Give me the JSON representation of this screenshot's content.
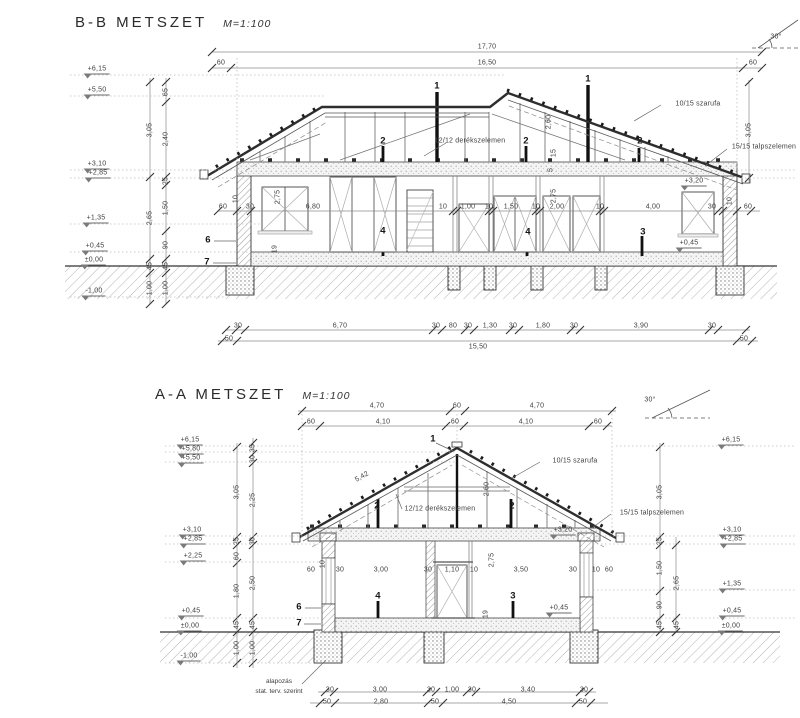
{
  "colors": {
    "paper": "#ffffff",
    "ink": "#3d3d3d",
    "bold": "#161616",
    "hatch": "#a8a8a8"
  },
  "bb": {
    "title": "B-B METSZET",
    "scale": "M=1:100",
    "labels": [
      {
        "t": "17,70",
        "x": 487,
        "y": 47
      },
      {
        "t": "16,50",
        "x": 487,
        "y": 63
      },
      {
        "t": "60",
        "x": 221,
        "y": 63
      },
      {
        "t": "60",
        "x": 753,
        "y": 63
      },
      {
        "t": "30°",
        "x": 776,
        "y": 37,
        "n": "roof-pitch-label"
      },
      {
        "t": "+6,15",
        "x": 97,
        "y": 70,
        "lv": 1
      },
      {
        "t": "+5,50",
        "x": 97,
        "y": 91,
        "lv": 1
      },
      {
        "t": "+3,10",
        "x": 97,
        "y": 165,
        "lv": 1
      },
      {
        "t": "+2,85",
        "x": 98,
        "y": 174,
        "lv": 1
      },
      {
        "t": "+1,35",
        "x": 96,
        "y": 219,
        "lv": 1
      },
      {
        "t": "+0,45",
        "x": 95,
        "y": 247,
        "lv": 1
      },
      {
        "t": "±0,00",
        "x": 94,
        "y": 261,
        "lv": 1
      },
      {
        "t": "-1,00",
        "x": 94,
        "y": 292,
        "lv": 1
      },
      {
        "t": "3,05",
        "x": 150,
        "y": 130,
        "r": -90
      },
      {
        "t": "2,65",
        "x": 150,
        "y": 218,
        "r": -90
      },
      {
        "t": "45",
        "x": 150,
        "y": 266,
        "r": -90
      },
      {
        "t": "1,00",
        "x": 150,
        "y": 288,
        "r": -90
      },
      {
        "t": "65",
        "x": 166,
        "y": 92,
        "r": -90
      },
      {
        "t": "2,40",
        "x": 166,
        "y": 139,
        "r": -90
      },
      {
        "t": "25",
        "x": 166,
        "y": 181,
        "r": -90
      },
      {
        "t": "1,50",
        "x": 166,
        "y": 208,
        "r": -90
      },
      {
        "t": "90",
        "x": 166,
        "y": 245,
        "r": -90
      },
      {
        "t": "45",
        "x": 166,
        "y": 266,
        "r": -90
      },
      {
        "t": "1,00",
        "x": 166,
        "y": 288,
        "r": -90
      },
      {
        "t": "3,05",
        "x": 749,
        "y": 130,
        "r": -90
      },
      {
        "t": "10/15 szarufa",
        "x": 698,
        "y": 104,
        "n": "rafter-label"
      },
      {
        "t": "15/15 talpszelemen",
        "x": 764,
        "y": 147,
        "n": "wall-plate-label"
      },
      {
        "t": "12/12 derékszelemen",
        "x": 470,
        "y": 141,
        "n": "purlin-label"
      },
      {
        "t": "2,60",
        "x": 549,
        "y": 122,
        "r": -90
      },
      {
        "t": "15",
        "x": 554,
        "y": 153,
        "r": -90
      },
      {
        "t": "5",
        "x": 551,
        "y": 170,
        "r": -90
      },
      {
        "t": "2,75",
        "x": 554,
        "y": 196,
        "r": -90
      },
      {
        "t": "2,75",
        "x": 278,
        "y": 197,
        "r": -90
      },
      {
        "t": "19",
        "x": 275,
        "y": 249,
        "r": -90
      },
      {
        "t": "10",
        "x": 236,
        "y": 199,
        "r": -90
      },
      {
        "t": "1",
        "x": 437,
        "y": 86,
        "b": 1
      },
      {
        "t": "1",
        "x": 588,
        "y": 79,
        "b": 1
      },
      {
        "t": "2",
        "x": 383,
        "y": 141,
        "b": 1
      },
      {
        "t": "2",
        "x": 526,
        "y": 141,
        "b": 1
      },
      {
        "t": "2",
        "x": 640,
        "y": 141,
        "b": 1
      },
      {
        "t": "4",
        "x": 383,
        "y": 231,
        "b": 1
      },
      {
        "t": "4",
        "x": 528,
        "y": 232,
        "b": 1
      },
      {
        "t": "3",
        "x": 643,
        "y": 232,
        "b": 1
      },
      {
        "t": "6",
        "x": 208,
        "y": 240,
        "b": 1
      },
      {
        "t": "7",
        "x": 207,
        "y": 262,
        "b": 1
      },
      {
        "t": "60",
        "x": 223,
        "y": 207
      },
      {
        "t": "30",
        "x": 250,
        "y": 207
      },
      {
        "t": "6,80",
        "x": 313,
        "y": 207
      },
      {
        "t": "10",
        "x": 443,
        "y": 207
      },
      {
        "t": "1,00",
        "x": 468,
        "y": 207
      },
      {
        "t": "10",
        "x": 489,
        "y": 207
      },
      {
        "t": "1,50",
        "x": 511,
        "y": 207
      },
      {
        "t": "10",
        "x": 536,
        "y": 207
      },
      {
        "t": "2,00",
        "x": 557,
        "y": 207
      },
      {
        "t": "10",
        "x": 600,
        "y": 207
      },
      {
        "t": "4,00",
        "x": 653,
        "y": 207
      },
      {
        "t": "30",
        "x": 712,
        "y": 207
      },
      {
        "t": "10",
        "x": 730,
        "y": 201,
        "r": -90
      },
      {
        "t": "60",
        "x": 748,
        "y": 207
      },
      {
        "t": "+3,20",
        "x": 694,
        "y": 182,
        "lv": 1
      },
      {
        "t": "+0,45",
        "x": 689,
        "y": 244,
        "lv": 1
      },
      {
        "t": "30",
        "x": 238,
        "y": 326
      },
      {
        "t": "6,70",
        "x": 340,
        "y": 326
      },
      {
        "t": "30",
        "x": 436,
        "y": 326
      },
      {
        "t": "80",
        "x": 453,
        "y": 326
      },
      {
        "t": "30",
        "x": 468,
        "y": 326
      },
      {
        "t": "1,30",
        "x": 490,
        "y": 326
      },
      {
        "t": "30",
        "x": 513,
        "y": 326
      },
      {
        "t": "1,80",
        "x": 543,
        "y": 326
      },
      {
        "t": "30",
        "x": 574,
        "y": 326
      },
      {
        "t": "3,90",
        "x": 641,
        "y": 326
      },
      {
        "t": "30",
        "x": 712,
        "y": 326
      },
      {
        "t": "50",
        "x": 229,
        "y": 339
      },
      {
        "t": "15,50",
        "x": 478,
        "y": 347
      },
      {
        "t": "50",
        "x": 744,
        "y": 339
      }
    ]
  },
  "aa": {
    "title": "A-A METSZET",
    "scale": "M=1:100",
    "note1": "alapozás",
    "note2": "stat. terv. szerint",
    "labels": [
      {
        "t": "4,70",
        "x": 377,
        "y": 406
      },
      {
        "t": "60",
        "x": 457,
        "y": 406
      },
      {
        "t": "4,70",
        "x": 537,
        "y": 406
      },
      {
        "t": "60",
        "x": 311,
        "y": 422
      },
      {
        "t": "4,10",
        "x": 383,
        "y": 422
      },
      {
        "t": "60",
        "x": 455,
        "y": 422
      },
      {
        "t": "4,10",
        "x": 526,
        "y": 422
      },
      {
        "t": "60",
        "x": 598,
        "y": 422
      },
      {
        "t": "30°",
        "x": 650,
        "y": 400,
        "n": "roof-pitch-label"
      },
      {
        "t": "+6,15",
        "x": 190,
        "y": 441,
        "lv": 1
      },
      {
        "t": "+5,80",
        "x": 191,
        "y": 450,
        "lv": 1
      },
      {
        "t": "+5,50",
        "x": 191,
        "y": 459,
        "lv": 1
      },
      {
        "t": "+3,10",
        "x": 192,
        "y": 531,
        "lv": 1
      },
      {
        "t": "+2,85",
        "x": 193,
        "y": 540,
        "lv": 1
      },
      {
        "t": "+2,25",
        "x": 193,
        "y": 557,
        "lv": 1
      },
      {
        "t": "+0,45",
        "x": 191,
        "y": 612,
        "lv": 1
      },
      {
        "t": "±0,00",
        "x": 190,
        "y": 627,
        "lv": 1
      },
      {
        "t": "-1,00",
        "x": 189,
        "y": 657,
        "lv": 1
      },
      {
        "t": "3,05",
        "x": 237,
        "y": 492,
        "r": -90
      },
      {
        "t": "25",
        "x": 237,
        "y": 541,
        "r": -90
      },
      {
        "t": "60",
        "x": 237,
        "y": 556,
        "r": -90
      },
      {
        "t": "1,80",
        "x": 237,
        "y": 591,
        "r": -90
      },
      {
        "t": "45",
        "x": 237,
        "y": 625,
        "r": -90
      },
      {
        "t": "1,00",
        "x": 237,
        "y": 648,
        "r": -90
      },
      {
        "t": "35",
        "x": 253,
        "y": 448,
        "r": -90
      },
      {
        "t": "30",
        "x": 253,
        "y": 459,
        "r": -90
      },
      {
        "t": "2,25",
        "x": 253,
        "y": 500,
        "r": -90
      },
      {
        "t": "30",
        "x": 253,
        "y": 541,
        "r": -90
      },
      {
        "t": "2,50",
        "x": 253,
        "y": 583,
        "r": -90
      },
      {
        "t": "45",
        "x": 253,
        "y": 625,
        "r": -90
      },
      {
        "t": "1,00",
        "x": 253,
        "y": 648,
        "r": -90
      },
      {
        "t": "5,42",
        "x": 362,
        "y": 477,
        "r": -30
      },
      {
        "t": "2,60",
        "x": 487,
        "y": 489,
        "r": -90
      },
      {
        "t": "10/15 szarufa",
        "x": 575,
        "y": 461,
        "n": "rafter-label"
      },
      {
        "t": "12/12 derékszelemen",
        "x": 440,
        "y": 509,
        "n": "purlin-label"
      },
      {
        "t": "15/15 talpszelemen",
        "x": 652,
        "y": 513,
        "n": "wall-plate-label"
      },
      {
        "t": "1",
        "x": 433,
        "y": 439,
        "b": 1
      },
      {
        "t": "2",
        "x": 377,
        "y": 506,
        "b": 1
      },
      {
        "t": "2",
        "x": 512,
        "y": 506,
        "b": 1
      },
      {
        "t": "4",
        "x": 378,
        "y": 596,
        "b": 1
      },
      {
        "t": "3",
        "x": 513,
        "y": 596,
        "b": 1
      },
      {
        "t": "6",
        "x": 299,
        "y": 607,
        "b": 1
      },
      {
        "t": "7",
        "x": 299,
        "y": 623,
        "b": 1
      },
      {
        "t": "60",
        "x": 311,
        "y": 570
      },
      {
        "t": "10",
        "x": 323,
        "y": 564,
        "r": -90
      },
      {
        "t": "30",
        "x": 340,
        "y": 570
      },
      {
        "t": "3,00",
        "x": 381,
        "y": 570
      },
      {
        "t": "30",
        "x": 428,
        "y": 570
      },
      {
        "t": "1,10",
        "x": 452,
        "y": 570
      },
      {
        "t": "10",
        "x": 474,
        "y": 570
      },
      {
        "t": "3,50",
        "x": 521,
        "y": 570
      },
      {
        "t": "30",
        "x": 573,
        "y": 570
      },
      {
        "t": "10",
        "x": 596,
        "y": 570
      },
      {
        "t": "60",
        "x": 609,
        "y": 570
      },
      {
        "t": "2,75",
        "x": 492,
        "y": 560,
        "r": -90
      },
      {
        "t": "19",
        "x": 486,
        "y": 614,
        "r": -90
      },
      {
        "t": "+3,20",
        "x": 563,
        "y": 531,
        "lv": 1
      },
      {
        "t": "+0,45",
        "x": 559,
        "y": 609,
        "lv": 1
      },
      {
        "t": "+6,15",
        "x": 731,
        "y": 441,
        "lv": 1
      },
      {
        "t": "+3,10",
        "x": 732,
        "y": 531,
        "lv": 1
      },
      {
        "t": "+2,85",
        "x": 733,
        "y": 540,
        "lv": 1
      },
      {
        "t": "+1,35",
        "x": 732,
        "y": 585,
        "lv": 1
      },
      {
        "t": "+0,45",
        "x": 732,
        "y": 612,
        "lv": 1
      },
      {
        "t": "±0,00",
        "x": 731,
        "y": 627,
        "lv": 1
      },
      {
        "t": "3,05",
        "x": 660,
        "y": 492,
        "r": -90
      },
      {
        "t": "25",
        "x": 660,
        "y": 541,
        "r": -90
      },
      {
        "t": "1,50",
        "x": 660,
        "y": 568,
        "r": -90
      },
      {
        "t": "90",
        "x": 660,
        "y": 605,
        "r": -90
      },
      {
        "t": "45",
        "x": 660,
        "y": 625,
        "r": -90
      },
      {
        "t": "2,65",
        "x": 677,
        "y": 583,
        "r": -90
      },
      {
        "t": "45",
        "x": 677,
        "y": 625,
        "r": -90
      },
      {
        "t": "30",
        "x": 330,
        "y": 690
      },
      {
        "t": "3,00",
        "x": 380,
        "y": 690
      },
      {
        "t": "30",
        "x": 431,
        "y": 690
      },
      {
        "t": "1,00",
        "x": 452,
        "y": 690
      },
      {
        "t": "30",
        "x": 472,
        "y": 690
      },
      {
        "t": "3,40",
        "x": 528,
        "y": 690
      },
      {
        "t": "30",
        "x": 584,
        "y": 690
      },
      {
        "t": "50",
        "x": 327,
        "y": 702
      },
      {
        "t": "2,80",
        "x": 381,
        "y": 702
      },
      {
        "t": "50",
        "x": 435,
        "y": 702
      },
      {
        "t": "4,50",
        "x": 509,
        "y": 702
      },
      {
        "t": "50",
        "x": 583,
        "y": 702
      }
    ]
  }
}
